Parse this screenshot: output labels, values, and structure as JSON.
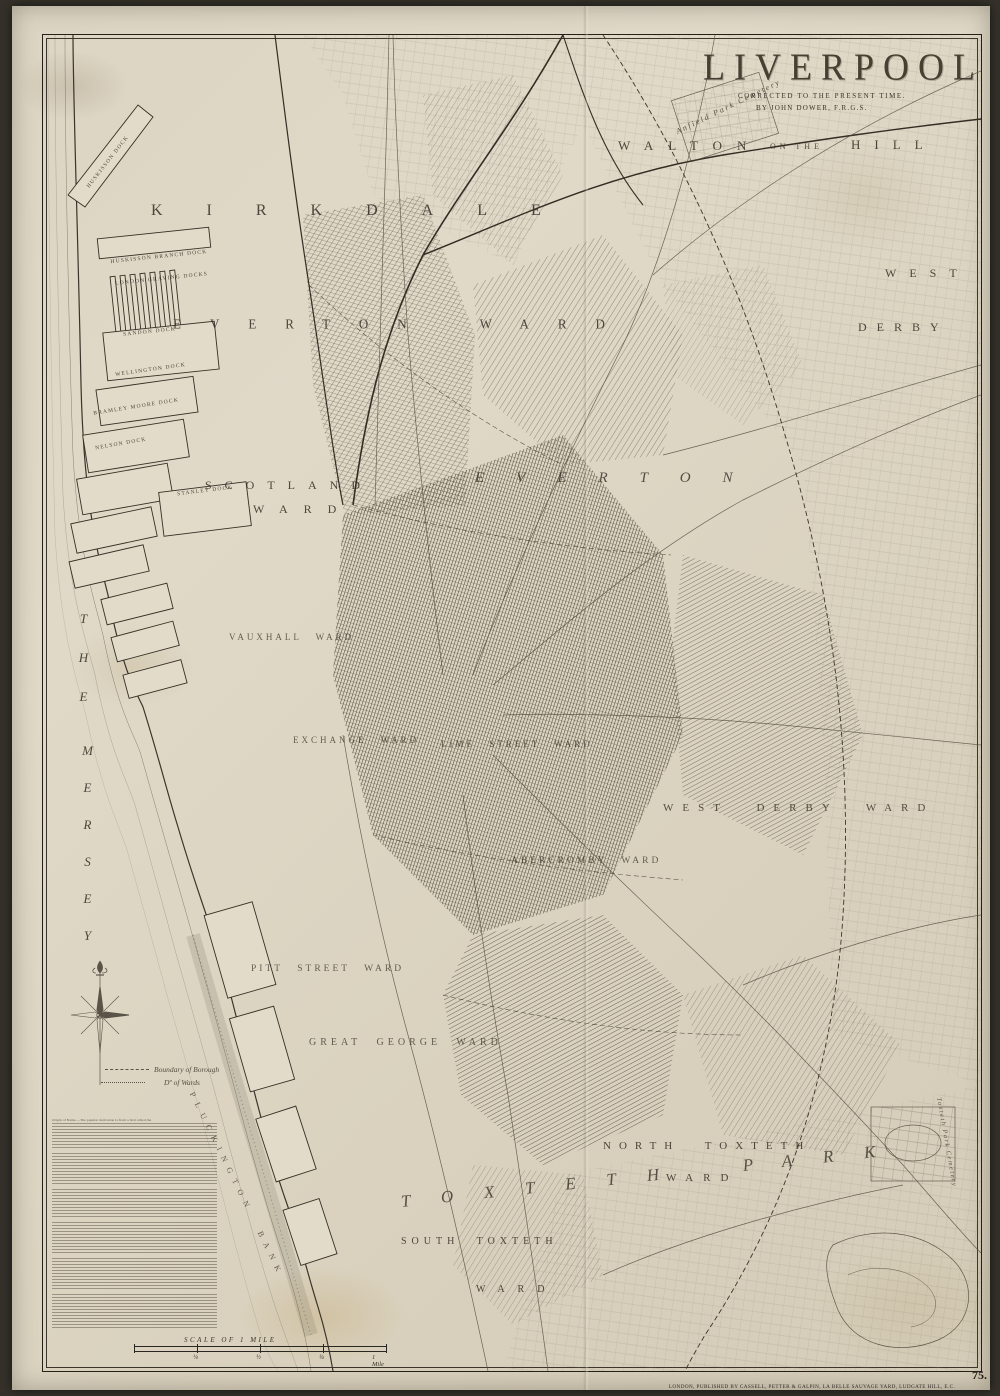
{
  "map_colors": {
    "paper": "#ddd5c3",
    "ink": "#3a342a",
    "urban_hatch": "#4e483a"
  },
  "title_block": {
    "title": "LIVERPOOL",
    "subtitle": "CORRECTED TO THE PRESENT TIME.",
    "author": "BY JOHN DOWER, F.R.G.S."
  },
  "labels": {
    "walton": {
      "w": "WALTON",
      "mid": "ON THE",
      "h": "HILL"
    },
    "anfield_cemetery": "Anfield Park Cemetery",
    "kirkdale": "KIRKDALE",
    "west_derby_upper": {
      "line1": "WEST",
      "line2": "DERBY"
    },
    "everton_ward": "EVERTON WARD",
    "everton": "EVERTON",
    "scotland_ward": {
      "line1": "SCOTLAND",
      "line2": "WARD"
    },
    "vauxhall_ward": "VAUXHALL WARD",
    "exchange_ward": "EXCHANGE WARD",
    "lime_street_ward": "LIME STREET WARD",
    "abercromby_ward": "ABERCROMBY WARD",
    "west_derby_ward": "WEST DERBY WARD",
    "pitt_street_ward": "PITT STREET WARD",
    "great_george_ward": "GREAT GEORGE WARD",
    "north_toxteth": {
      "line1": "NORTH TOXTETH",
      "line2": "WARD"
    },
    "toxteth_park": "TOXTETH PARK",
    "south_toxteth": {
      "line1": "SOUTH TOXTETH",
      "line2": "WARD"
    },
    "mersey": {
      "word1": "THE",
      "word2": "MERSEY"
    },
    "pluckington_bank": "PLUCKINGTON BANK",
    "toxteth_cemetery": "Toxteth Park Cemetery"
  },
  "docks": [
    "HUSKISSON DOCK",
    "HUSKISSON BRANCH DOCK",
    "LONDON GRAVING DOCKS",
    "SANDON DOCK",
    "WELLINGTON DOCK",
    "BRAMLEY MOORE DOCK",
    "NELSON DOCK",
    "STANLEY DOCK"
  ],
  "legend": {
    "boundary_borough": "Boundary of Borough",
    "boundary_wards": "Dº of Wards"
  },
  "stats_block": {
    "lead": "Origin of Name.—The popular derivation is from a bird called the"
  },
  "scale": {
    "caption": "SCALE OF 1 MILE",
    "labels": [
      "¼",
      "½",
      "¾",
      "1 Mile"
    ]
  },
  "imprint": "LONDON, PUBLISHED BY CASSELL, PETTER & GALPIN, LA BELLE SAUVAGE YARD, LUDGATE HILL, E.C.",
  "plate_number": "75."
}
